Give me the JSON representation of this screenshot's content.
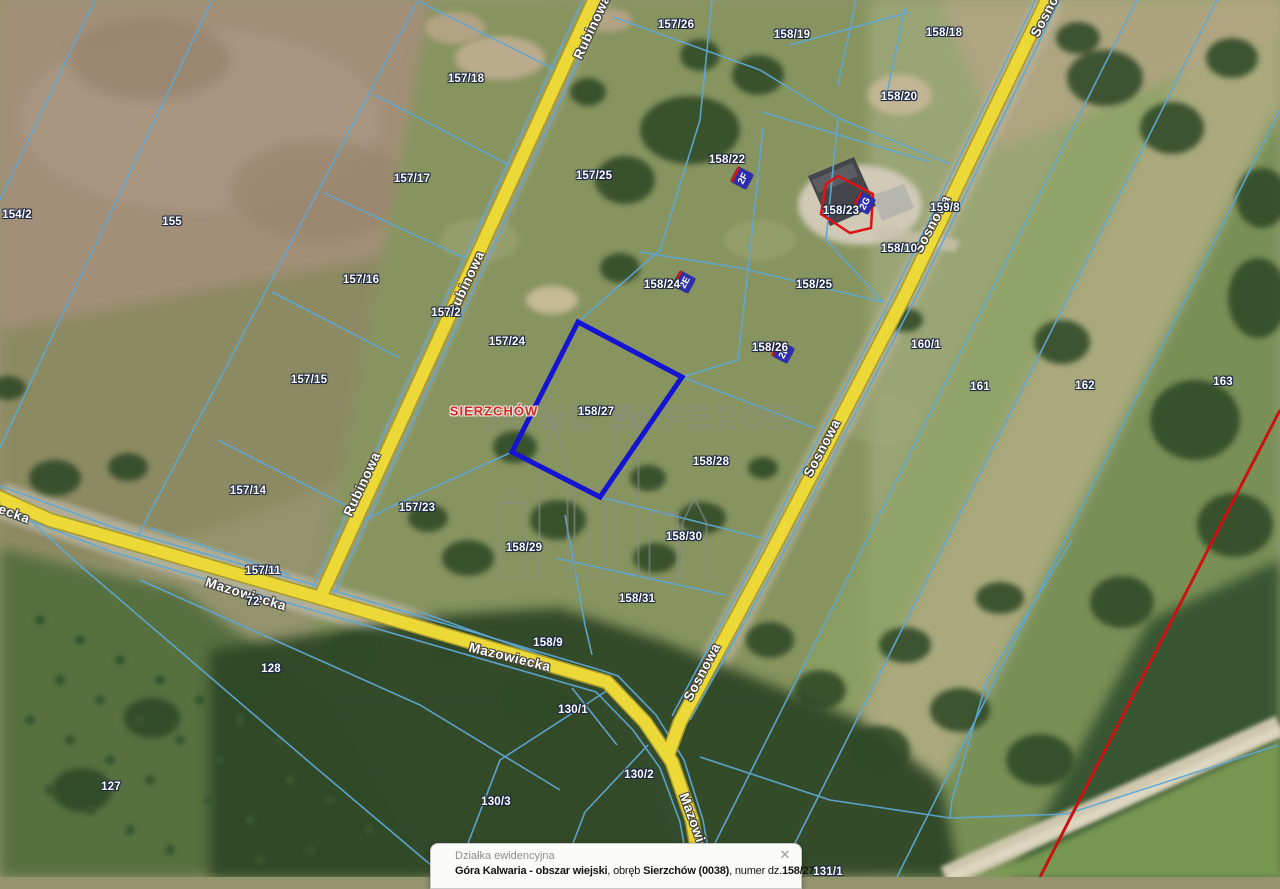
{
  "map": {
    "colors": {
      "road_fill": "#ecd937",
      "road_casing": "#a79b2e",
      "parcel_line": "#5fa8d4",
      "highlight_parcel": "#1414d2",
      "highlight_building": "#e01212",
      "marker_blue": "#2d2db0",
      "boundary_red_line": "#cc1111"
    },
    "place_label": {
      "text": "SIERZCHÓW"
    },
    "highlighted_parcel": "158/27",
    "parcel_labels": [
      {
        "text": "157/26",
        "x": 676,
        "y": 25
      },
      {
        "text": "157/18",
        "x": 466,
        "y": 79
      },
      {
        "text": "158/19",
        "x": 792,
        "y": 35
      },
      {
        "text": "158/18",
        "x": 944,
        "y": 33
      },
      {
        "text": "158/20",
        "x": 899,
        "y": 97
      },
      {
        "text": "157/17",
        "x": 412,
        "y": 179
      },
      {
        "text": "157/25",
        "x": 594,
        "y": 176
      },
      {
        "text": "158/22",
        "x": 727,
        "y": 160
      },
      {
        "text": "158/23",
        "x": 841,
        "y": 211
      },
      {
        "text": "158/10",
        "x": 899,
        "y": 249
      },
      {
        "text": "159/8",
        "x": 945,
        "y": 208
      },
      {
        "text": "154/2",
        "x": 17,
        "y": 215
      },
      {
        "text": "155",
        "x": 172,
        "y": 222
      },
      {
        "text": "157/16",
        "x": 361,
        "y": 280
      },
      {
        "text": "157/2",
        "x": 446,
        "y": 313
      },
      {
        "text": "157/24",
        "x": 507,
        "y": 342
      },
      {
        "text": "158/24",
        "x": 662,
        "y": 285
      },
      {
        "text": "158/25",
        "x": 814,
        "y": 285
      },
      {
        "text": "158/26",
        "x": 770,
        "y": 348
      },
      {
        "text": "160/1",
        "x": 926,
        "y": 345
      },
      {
        "text": "161",
        "x": 980,
        "y": 387
      },
      {
        "text": "162",
        "x": 1085,
        "y": 386
      },
      {
        "text": "163",
        "x": 1223,
        "y": 382
      },
      {
        "text": "157/15",
        "x": 309,
        "y": 380
      },
      {
        "text": "158/27",
        "x": 596,
        "y": 412
      },
      {
        "text": "158/28",
        "x": 711,
        "y": 462
      },
      {
        "text": "157/14",
        "x": 248,
        "y": 491
      },
      {
        "text": "157/23",
        "x": 417,
        "y": 508
      },
      {
        "text": "158/29",
        "x": 524,
        "y": 548
      },
      {
        "text": "158/30",
        "x": 684,
        "y": 537
      },
      {
        "text": "157/11",
        "x": 263,
        "y": 571
      },
      {
        "text": "72",
        "x": 253,
        "y": 602
      },
      {
        "text": "158/31",
        "x": 637,
        "y": 599
      },
      {
        "text": "158/9",
        "x": 548,
        "y": 643
      },
      {
        "text": "128",
        "x": 271,
        "y": 669
      },
      {
        "text": "130/1",
        "x": 573,
        "y": 710
      },
      {
        "text": "130/2",
        "x": 639,
        "y": 775
      },
      {
        "text": "130/3",
        "x": 496,
        "y": 802
      },
      {
        "text": "127",
        "x": 111,
        "y": 787
      },
      {
        "text": "131/1",
        "x": 828,
        "y": 872
      }
    ],
    "road_labels": [
      {
        "text": "Rubinowa",
        "x": 592,
        "y": 27,
        "rot": -65
      },
      {
        "text": "Rubinowa",
        "x": 466,
        "y": 283,
        "rot": -65
      },
      {
        "text": "Rubinowa",
        "x": 362,
        "y": 484,
        "rot": -65
      },
      {
        "text": "Mazowiecka",
        "x": -10,
        "y": 505,
        "rot": 20
      },
      {
        "text": "Mazowiecka",
        "x": 246,
        "y": 594,
        "rot": 17
      },
      {
        "text": "Mazowiecka",
        "x": 510,
        "y": 657,
        "rot": 14
      },
      {
        "text": "Mazowiecka",
        "x": 698,
        "y": 833,
        "rot": 70
      },
      {
        "text": "Sosnowa",
        "x": 1049,
        "y": 8,
        "rot": -62
      },
      {
        "text": "Sosnowa",
        "x": 932,
        "y": 224,
        "rot": -62
      },
      {
        "text": "Sosnowa",
        "x": 822,
        "y": 448,
        "rot": -62
      },
      {
        "text": "Sosnowa",
        "x": 702,
        "y": 672,
        "rot": -62
      }
    ],
    "address_markers": [
      {
        "text": "2F",
        "x": 742,
        "y": 178
      },
      {
        "text": "2G",
        "x": 864,
        "y": 203
      },
      {
        "text": "2E",
        "x": 684,
        "y": 282
      },
      {
        "text": "2D",
        "x": 783,
        "y": 352
      }
    ]
  },
  "watermark": {
    "text": "HOME EMPEROR"
  },
  "popup": {
    "title": "Działka ewidencyjna",
    "close_icon": "✕",
    "segments": [
      {
        "t": "Góra Kalwaria",
        "b": 1
      },
      {
        "t": " - ",
        "b": 1
      },
      {
        "t": "obszar wiejski",
        "b": 1
      },
      {
        "t": ", obręb ",
        "b": 0
      },
      {
        "t": "Sierzchów (0038)",
        "b": 1
      },
      {
        "t": ", numer dz.",
        "b": 0
      },
      {
        "t": "158/27",
        "b": 1
      }
    ]
  }
}
